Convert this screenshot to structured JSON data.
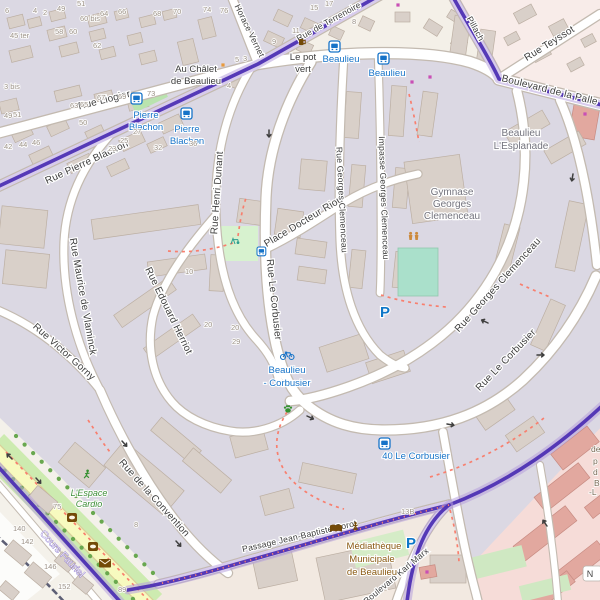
{
  "colors": {
    "boundary": "#4a2db2",
    "boundary_halo": "#b7a1dc",
    "residential_landuse": "#dbd8e3",
    "default_land": "#f2efe9",
    "retail_landuse": "#f6dcd8",
    "building": "#d9d0c9",
    "building_retail": "#e2a89f",
    "road_fill": "#ffffff",
    "road_casing": "#c3bab0",
    "secondary_road_yellow": "#f7fabf",
    "grass": "#cdebb0",
    "pitch": "#aae0cb",
    "footpath_red": "#f87f6e",
    "transit_blue": "#1673c8",
    "poi_brown": "#734a08",
    "leisure_green": "#3f8f3a",
    "street_label": "#3e3e3e",
    "place_label": "#73737d",
    "housenumber_gray": "#9b9186"
  },
  "map": {
    "streets": {
      "liogier": "Rue Liogier",
      "horace_vernet": "Horace Vernet",
      "terrenoire": "Rue de Terrenoire",
      "pillach": "Pillach",
      "teyssot": "Rue Teyssot",
      "palle": "Boulevard de la Palle",
      "pierre_blachon": "Rue Pierre Blachon",
      "henri_dunant": "Rue Henri Dunant",
      "edouard_herriot": "Rue Edouard Herriot",
      "maurice_vlaminck": "Rue Maurice de Vlaminck",
      "victor_gorny": "Rue Victor Gorny",
      "docteur_riou": "Place Docteur Riou",
      "le_corbusier": "Rue Le Corbusier",
      "georges_clemenceau": "Rue Georges Clemenceau",
      "impasse_clemenceau": "Impasse Georges Clemenceau",
      "convention": "Rue de la Convention",
      "cours_fauriel": "Cours Fauriel",
      "passage_corot": "Passage Jean-Baptiste Corot",
      "karl_marx": "Boulevard Karl Marx"
    },
    "places": {
      "au_chalet": [
        "Au Châlet",
        "de Beaulieu"
      ],
      "esplanade": [
        "Beaulieu",
        "L'Esplanade"
      ],
      "gymnase": [
        "Gymnase",
        "Georges",
        "Clemenceau"
      ],
      "mediatheque": [
        "Médiathèque",
        "Municipale",
        "de Beaulieu"
      ],
      "espace_cardio": [
        "L'Espace",
        "Cardio"
      ],
      "le_pot_vert": [
        "Le pot",
        "vert"
      ]
    },
    "transit": {
      "pierre_blachon": [
        "Pierre",
        "Blachon"
      ],
      "beaulieu": "Beaulieu",
      "beaulieu_corbusier": [
        "Beaulieu",
        "- Corbusier"
      ],
      "le_corbusier_40": "40 Le Corbusier",
      "parking": "P"
    },
    "misc": {
      "n_shield": "N",
      "edge_fragments": [
        {
          "t": "de",
          "x": 591,
          "y": 452
        },
        {
          "t": "p",
          "x": 593,
          "y": 464
        },
        {
          "t": "d",
          "x": 593,
          "y": 475
        },
        {
          "t": "B",
          "x": 594,
          "y": 486
        },
        {
          "t": "-L",
          "x": 589,
          "y": 495
        }
      ]
    },
    "icons": {
      "bus_stop": "bus-icon",
      "bicycle_rental": "bicycle-icon",
      "parking": "parking-p-icon",
      "library": "open-book-icon",
      "monument": "statue-icon",
      "post_office": "envelope-icon",
      "bank": "safe-icon",
      "sports_hall": "gymnasts-icon",
      "dog_area": "paw-icon",
      "fitness": "runner-icon",
      "bar": "mug-icon",
      "playground": "swing-icon",
      "oneway": "oneway-arrow-icon"
    },
    "house_numbers": [
      [
        5,
        13,
        "6"
      ],
      [
        33,
        13,
        "4"
      ],
      [
        43,
        15,
        "2"
      ],
      [
        57,
        11,
        "49"
      ],
      [
        77,
        6,
        "51"
      ],
      [
        80,
        21,
        "60 bis"
      ],
      [
        100,
        16,
        "64"
      ],
      [
        118,
        14,
        "66"
      ],
      [
        153,
        16,
        "68"
      ],
      [
        173,
        14,
        "70"
      ],
      [
        55,
        34,
        "58"
      ],
      [
        69,
        34,
        "60"
      ],
      [
        10,
        38,
        "45 ter"
      ],
      [
        93,
        48,
        "62"
      ],
      [
        4,
        89,
        "3 bis"
      ],
      [
        147,
        96,
        "73"
      ],
      [
        70,
        108,
        "63"
      ],
      [
        80,
        107,
        "65"
      ],
      [
        97,
        100,
        "67"
      ],
      [
        118,
        99,
        "69"
      ],
      [
        79,
        125,
        "50"
      ],
      [
        4,
        118,
        "49"
      ],
      [
        13,
        117,
        "51"
      ],
      [
        4,
        149,
        "42"
      ],
      [
        19,
        147,
        "44"
      ],
      [
        32,
        145,
        "46"
      ],
      [
        108,
        151,
        "23"
      ],
      [
        120,
        143,
        "25"
      ],
      [
        133,
        134,
        "27"
      ],
      [
        154,
        150,
        "32"
      ],
      [
        189,
        146,
        "36"
      ],
      [
        203,
        12,
        "74"
      ],
      [
        220,
        13,
        "76"
      ],
      [
        310,
        10,
        "15"
      ],
      [
        325,
        6,
        "17"
      ],
      [
        352,
        24,
        "8"
      ],
      [
        292,
        33,
        "11"
      ],
      [
        272,
        44,
        "9"
      ],
      [
        235,
        62,
        "5"
      ],
      [
        243,
        61,
        "3"
      ],
      [
        227,
        88,
        "4"
      ],
      [
        185,
        274,
        "10"
      ],
      [
        204,
        327,
        "20"
      ],
      [
        231,
        330,
        "20"
      ],
      [
        232,
        344,
        "29"
      ],
      [
        134,
        527,
        "8"
      ],
      [
        53,
        509,
        "75"
      ],
      [
        13,
        531,
        "140"
      ],
      [
        21,
        544,
        "142"
      ],
      [
        44,
        569,
        "146"
      ],
      [
        58,
        589,
        "152"
      ],
      [
        118,
        592,
        "89"
      ],
      [
        401,
        514,
        "13B"
      ]
    ],
    "arrows": [
      [
        269,
        130,
        90
      ],
      [
        488,
        323,
        205
      ],
      [
        537,
        355,
        0
      ],
      [
        447,
        424,
        10
      ],
      [
        122,
        441,
        48
      ],
      [
        176,
        541,
        48
      ],
      [
        12,
        459,
        225
      ],
      [
        36,
        478,
        48
      ],
      [
        573,
        174,
        100
      ],
      [
        547,
        526,
        235
      ],
      [
        307,
        416,
        25
      ]
    ],
    "poi_dots": [
      [
        398,
        5,
        "#c94fb5"
      ],
      [
        412,
        82,
        "#c94fb5"
      ],
      [
        430,
        77,
        "#c94fb5"
      ],
      [
        585,
        114,
        "#c94fb5"
      ],
      [
        427,
        572,
        "#c94fb5"
      ],
      [
        223,
        65,
        "#e89a3c"
      ]
    ],
    "buildings": [
      [
        8,
        16,
        16,
        11,
        -14
      ],
      [
        28,
        18,
        13,
        9,
        -14
      ],
      [
        50,
        10,
        15,
        10,
        -14
      ],
      [
        88,
        14,
        18,
        11,
        -14
      ],
      [
        115,
        10,
        13,
        9,
        -14
      ],
      [
        140,
        16,
        15,
        10,
        -14
      ],
      [
        163,
        10,
        13,
        9,
        -14
      ],
      [
        48,
        28,
        18,
        11,
        -14
      ],
      [
        90,
        30,
        15,
        10,
        -14
      ],
      [
        128,
        34,
        14,
        10,
        -14
      ],
      [
        10,
        48,
        22,
        12,
        -14
      ],
      [
        60,
        44,
        18,
        11,
        -14
      ],
      [
        100,
        48,
        15,
        10,
        -14
      ],
      [
        140,
        52,
        16,
        11,
        -14
      ],
      [
        180,
        40,
        16,
        24,
        -14
      ],
      [
        200,
        18,
        14,
        20,
        -14
      ],
      [
        0,
        100,
        18,
        12,
        -14
      ],
      [
        55,
        88,
        26,
        11,
        -14
      ],
      [
        95,
        92,
        18,
        11,
        -14
      ],
      [
        128,
        98,
        20,
        11,
        -14
      ],
      [
        12,
        128,
        20,
        11,
        -25
      ],
      [
        48,
        122,
        20,
        11,
        -25
      ],
      [
        86,
        128,
        18,
        10,
        -25
      ],
      [
        120,
        135,
        24,
        12,
        -25
      ],
      [
        160,
        118,
        22,
        12,
        -25
      ],
      [
        30,
        150,
        22,
        11,
        -25
      ],
      [
        68,
        158,
        24,
        11,
        -25
      ],
      [
        108,
        162,
        20,
        11,
        -25
      ],
      [
        148,
        140,
        18,
        10,
        -25
      ],
      [
        225,
        75,
        16,
        12,
        20
      ],
      [
        275,
        12,
        16,
        12,
        25
      ],
      [
        302,
        20,
        14,
        11,
        25
      ],
      [
        330,
        28,
        13,
        10,
        25
      ],
      [
        265,
        34,
        18,
        11,
        25
      ],
      [
        298,
        42,
        14,
        11,
        25
      ],
      [
        360,
        18,
        13,
        11,
        25
      ],
      [
        395,
        12,
        15,
        10,
        0
      ],
      [
        425,
        22,
        16,
        11,
        32
      ],
      [
        452,
        38,
        14,
        10,
        32
      ],
      [
        448,
        12,
        13,
        9,
        32
      ],
      [
        515,
        8,
        20,
        12,
        -28
      ],
      [
        550,
        22,
        17,
        11,
        -28
      ],
      [
        582,
        36,
        13,
        9,
        -28
      ],
      [
        532,
        48,
        18,
        11,
        -28
      ],
      [
        568,
        60,
        15,
        9,
        -28
      ],
      [
        505,
        34,
        14,
        9,
        -28
      ],
      [
        572,
        96,
        26,
        42,
        10,
        "p"
      ],
      [
        0,
        208,
        46,
        38,
        6
      ],
      [
        4,
        252,
        44,
        34,
        6
      ],
      [
        92,
        212,
        108,
        20,
        -8
      ],
      [
        148,
        258,
        58,
        15,
        -8
      ],
      [
        112,
        295,
        66,
        15,
        -35
      ],
      [
        142,
        330,
        60,
        14,
        -35
      ],
      [
        238,
        200,
        26,
        24,
        8
      ],
      [
        276,
        210,
        26,
        26,
        8
      ],
      [
        210,
        255,
        14,
        36,
        3
      ],
      [
        296,
        240,
        30,
        16,
        8
      ],
      [
        298,
        268,
        28,
        14,
        8
      ],
      [
        300,
        160,
        26,
        30,
        5
      ],
      [
        345,
        92,
        15,
        46,
        4
      ],
      [
        390,
        86,
        15,
        50,
        4
      ],
      [
        420,
        92,
        15,
        44,
        8
      ],
      [
        350,
        165,
        14,
        42,
        5
      ],
      [
        394,
        168,
        14,
        40,
        5
      ],
      [
        350,
        250,
        14,
        38,
        6
      ],
      [
        394,
        252,
        14,
        36,
        6
      ],
      [
        408,
        158,
        56,
        62,
        -8
      ],
      [
        452,
        16,
        16,
        44,
        8
      ],
      [
        478,
        30,
        15,
        40,
        8
      ],
      [
        505,
        120,
        44,
        16,
        -30
      ],
      [
        545,
        140,
        40,
        15,
        -30
      ],
      [
        498,
        225,
        16,
        52,
        14
      ],
      [
        562,
        202,
        20,
        68,
        12
      ],
      [
        540,
        300,
        16,
        50,
        24
      ],
      [
        322,
        340,
        44,
        26,
        -18
      ],
      [
        368,
        356,
        40,
        22,
        -18
      ],
      [
        232,
        432,
        34,
        22,
        -15
      ],
      [
        262,
        492,
        30,
        20,
        -15
      ],
      [
        300,
        468,
        55,
        20,
        12
      ],
      [
        150,
        432,
        52,
        17,
        40
      ],
      [
        182,
        462,
        50,
        17,
        40
      ],
      [
        105,
        462,
        78,
        32,
        40
      ],
      [
        62,
        452,
        40,
        26,
        40
      ],
      [
        30,
        492,
        26,
        15,
        40
      ],
      [
        6,
        546,
        24,
        14,
        40
      ],
      [
        26,
        568,
        24,
        14,
        40
      ],
      [
        0,
        585,
        18,
        11,
        40
      ],
      [
        56,
        556,
        18,
        12,
        40
      ],
      [
        74,
        578,
        18,
        12,
        40
      ],
      [
        320,
        550,
        72,
        46,
        -12
      ],
      [
        255,
        555,
        40,
        30,
        -12
      ],
      [
        430,
        555,
        36,
        28,
        0
      ],
      [
        476,
        400,
        36,
        22,
        -35
      ],
      [
        508,
        424,
        34,
        20,
        -35
      ],
      [
        552,
        438,
        46,
        20,
        -38,
        "p"
      ],
      [
        534,
        478,
        56,
        19,
        -38,
        "p"
      ],
      [
        512,
        524,
        66,
        19,
        -38,
        "p"
      ],
      [
        552,
        556,
        56,
        17,
        -38,
        "p"
      ],
      [
        586,
        498,
        26,
        14,
        -38,
        "p"
      ],
      [
        528,
        584,
        48,
        14,
        -38,
        "p"
      ],
      [
        420,
        566,
        16,
        12,
        -10,
        "p"
      ]
    ]
  }
}
